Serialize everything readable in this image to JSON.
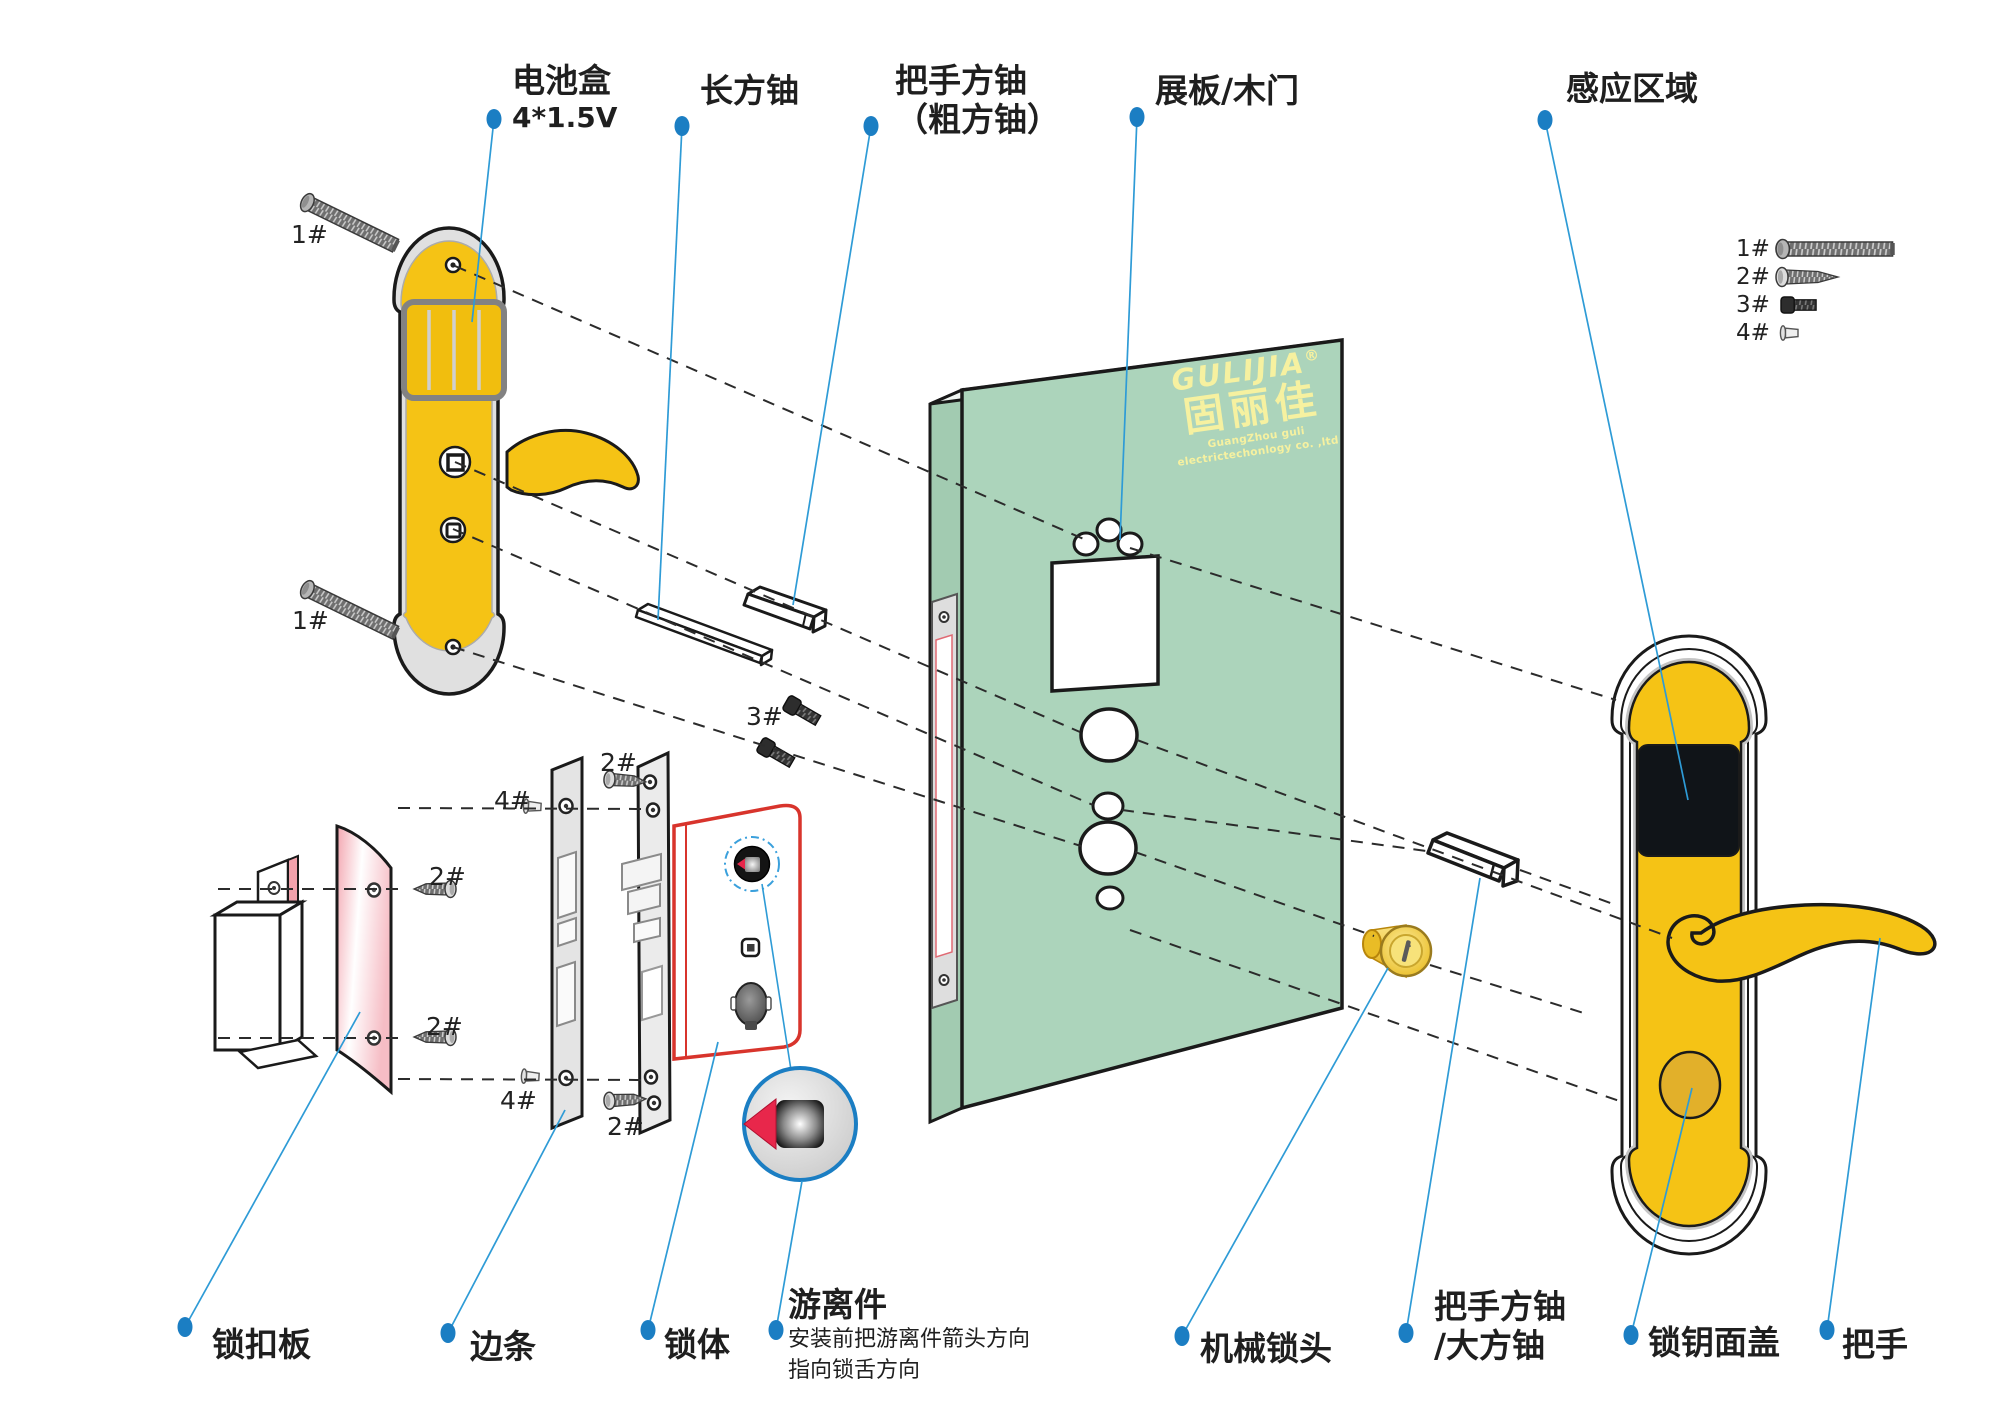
{
  "labels": {
    "battery_box": {
      "line1": "电池盒",
      "line2": "4*1.5V"
    },
    "long_spindle": "长方铀",
    "handle_spindle_top": {
      "line1": "把手方铀",
      "line2": "（粗方铀）"
    },
    "door": "展板/木门",
    "sensor_area": "感应区域",
    "strike_plate": "锁扣板",
    "edge_strip": "边条",
    "lock_body": "锁体",
    "floating_part": {
      "title": "游离件",
      "note_line1": "安装前把游离件箭头方向",
      "note_line2": "指向锁舌方向"
    },
    "mechanical_cylinder": "机械锁头",
    "handle_spindle_right": {
      "line1": "把手方铀",
      "line2": "/大方铀"
    },
    "key_cover": "锁钥面盖",
    "handle": "把手"
  },
  "screw_legend": [
    "1#",
    "2#",
    "3#",
    "4#"
  ],
  "inline_marks": [
    "1#",
    "1#",
    "4#",
    "4#",
    "2#",
    "2#",
    "2#",
    "2#",
    "3#"
  ],
  "logo": {
    "brand": "GULIJIA",
    "registered": "®",
    "chinese": "固丽佳",
    "company": "GuangZhou guli electrictechonlogy co. ,ltd"
  },
  "colors": {
    "accent_blue": "#1B7EC3",
    "leader_blue": "#2E9BD6",
    "panel_yellow": "#F5C315",
    "door_green": "#ACD4BB",
    "lock_body_red": "#D8342C",
    "strike_pink": "#F2A3AC",
    "logo_yellow": "#F6F1A0",
    "arrow_red": "#E8274B",
    "sensor_black": "#101418"
  }
}
